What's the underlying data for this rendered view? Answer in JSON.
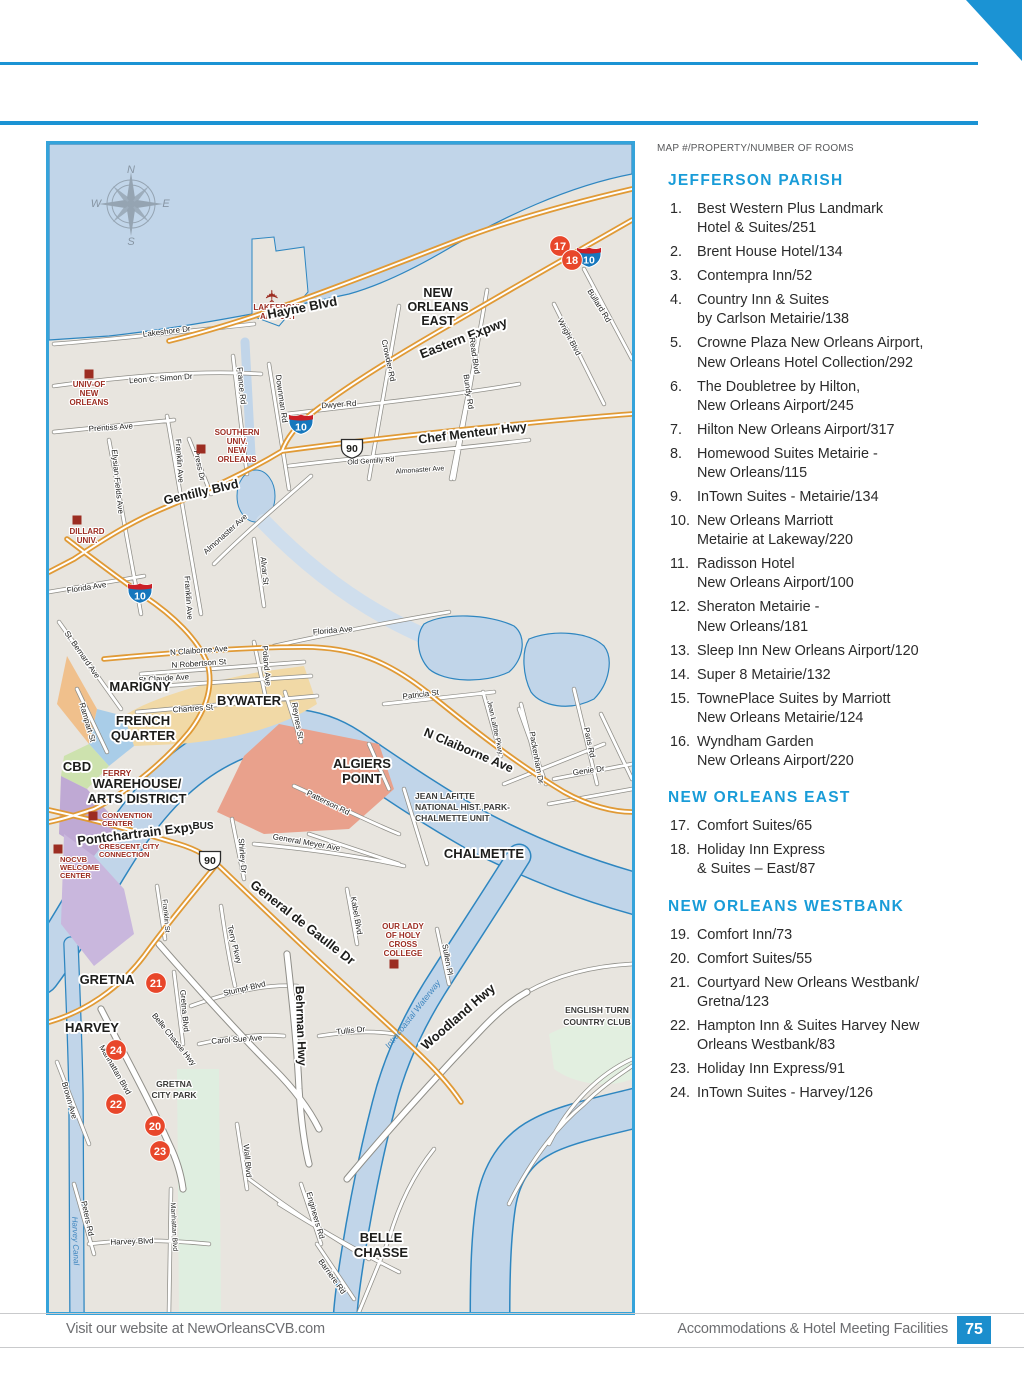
{
  "accent_colors": {
    "cyan_header": "#199cd8",
    "rule_blue": "#1b93d4",
    "page_box_blue": "#1b8ecd",
    "marker_red": "#e8472b",
    "poi_red": "#9c2d22",
    "shield_blue": "#1677bd",
    "shield_red_band": "#cb2027",
    "water": "#c1d5e9",
    "land": "#e8e5df",
    "road_orange": "#e09a36"
  },
  "listing": {
    "legend": "MAP #/PROPERTY/NUMBER OF ROOMS",
    "sections": [
      {
        "title": "JEFFERSON PARISH",
        "items": [
          {
            "n": "1.",
            "text": "Best Western Plus Landmark\nHotel & Suites/251"
          },
          {
            "n": "2.",
            "text": "Brent House Hotel/134"
          },
          {
            "n": "3.",
            "text": "Contempra Inn/52"
          },
          {
            "n": "4.",
            "text": "Country Inn & Suites\nby Carlson Metairie/138"
          },
          {
            "n": "5.",
            "text": "Crowne Plaza New Orleans Airport,\nNew Orleans Hotel Collection/292"
          },
          {
            "n": "6.",
            "text": "The Doubletree by Hilton,\nNew Orleans Airport/245"
          },
          {
            "n": "7.",
            "text": "Hilton New Orleans Airport/317"
          },
          {
            "n": "8.",
            "text": "Homewood Suites Metairie -\nNew Orleans/115"
          },
          {
            "n": "9.",
            "text": "InTown Suites - Metairie/134"
          },
          {
            "n": "10.",
            "text": "New Orleans Marriott\nMetairie at Lakeway/220"
          },
          {
            "n": "11.",
            "text": "Radisson Hotel\nNew Orleans Airport/100"
          },
          {
            "n": "12.",
            "text": "Sheraton Metairie -\nNew Orleans/181"
          },
          {
            "n": "13.",
            "text": "Sleep Inn New Orleans Airport/120"
          },
          {
            "n": "14.",
            "text": "Super 8 Metairie/132"
          },
          {
            "n": "15.",
            "text": "TownePlace Suites by Marriott\nNew Orleans Metairie/124"
          },
          {
            "n": "16.",
            "text": "Wyndham Garden\nNew Orleans Airport/220"
          }
        ]
      },
      {
        "title": "NEW ORLEANS EAST",
        "items": [
          {
            "n": "17.",
            "text": "Comfort Suites/65"
          },
          {
            "n": "18.",
            "text": "Holiday Inn Express\n& Suites – East/87"
          }
        ]
      },
      {
        "title": "NEW ORLEANS WESTBANK",
        "items": [
          {
            "n": "19.",
            "text": "Comfort Inn/73"
          },
          {
            "n": "20.",
            "text": "Comfort Suites/55"
          },
          {
            "n": "21.",
            "text": "Courtyard New Orleans Westbank/\nGretna/123"
          },
          {
            "n": "22.",
            "text": "Hampton Inn & Suites Harvey New\nOrleans Westbank/83"
          },
          {
            "n": "23.",
            "text": "Holiday Inn Express/91"
          },
          {
            "n": "24.",
            "text": "InTown Suites - Harvey/126"
          }
        ]
      }
    ]
  },
  "footer": {
    "left": "Visit our website at NewOrleansCVB.com",
    "right": "Accommodations & Hotel Meeting Facilities",
    "page": "75"
  },
  "map": {
    "compass": {
      "n": "N",
      "e": "E",
      "s": "S",
      "w": "W",
      "x": 82,
      "y": 60
    },
    "labels": [
      {
        "t": "✈",
        "x": 229,
        "y": 152,
        "s": 17,
        "c": "#9c2d22",
        "r": -90,
        "halo": false
      },
      {
        "t": "LAKEFRONT",
        "x": 229,
        "y": 166,
        "s": 8,
        "w": "b",
        "c": "#9c2d22"
      },
      {
        "t": "AIRPORT",
        "x": 229,
        "y": 175,
        "s": 8,
        "w": "b",
        "c": "#9c2d22"
      },
      {
        "t": "Lakeshore Dr",
        "x": 118,
        "y": 190,
        "r": -7
      },
      {
        "t": "Leon C. Simon Dr",
        "x": 112,
        "y": 237,
        "r": -4
      },
      {
        "t": "Hayne Blvd",
        "x": 254,
        "y": 168,
        "r": -11,
        "s": 13,
        "w": "b"
      },
      {
        "t": "Eastern Expwy",
        "x": 416,
        "y": 198,
        "r": -21,
        "s": 13,
        "w": "b"
      },
      {
        "t": "NEW",
        "x": 389,
        "y": 153,
        "s": 12.5,
        "w": "b"
      },
      {
        "t": "ORLEANS",
        "x": 389,
        "y": 167,
        "s": 12.5,
        "w": "b"
      },
      {
        "t": "EAST",
        "x": 389,
        "y": 181,
        "s": 12.5,
        "w": "b"
      },
      {
        "t": "Crowder Rd",
        "x": 337,
        "y": 217,
        "r": 78
      },
      {
        "t": "Read Blvd",
        "x": 423,
        "y": 212,
        "r": 82
      },
      {
        "t": "Bundy Rd",
        "x": 417,
        "y": 248,
        "r": 82
      },
      {
        "t": "Wright Blvd",
        "x": 518,
        "y": 194,
        "r": 62
      },
      {
        "t": "Bullard Rd",
        "x": 548,
        "y": 163,
        "r": 58
      },
      {
        "t": "Dwyer Rd",
        "x": 290,
        "y": 263,
        "r": -4
      },
      {
        "t": "Chef Menteur Hwy",
        "x": 424,
        "y": 293,
        "r": -7,
        "s": 12.5,
        "w": "b"
      },
      {
        "t": "Old Gentilly Rd",
        "x": 322,
        "y": 319,
        "r": -4,
        "s": 7
      },
      {
        "t": "Almonaster Ave",
        "x": 371,
        "y": 328,
        "r": -4,
        "s": 7
      },
      {
        "t": "Almonaster Ave",
        "x": 178,
        "y": 392,
        "r": -42
      },
      {
        "t": "Prentiss Ave",
        "x": 62,
        "y": 286,
        "r": -4
      },
      {
        "t": "Elysian Fields Ave",
        "x": 66,
        "y": 338,
        "r": 84
      },
      {
        "t": "Franklin Ave",
        "x": 128,
        "y": 317,
        "r": 86
      },
      {
        "t": "Press Dr",
        "x": 148,
        "y": 322,
        "r": 78
      },
      {
        "t": "France Rd",
        "x": 190,
        "y": 242,
        "r": 84
      },
      {
        "t": "Downman Rd",
        "x": 230,
        "y": 255,
        "r": 82
      },
      {
        "t": "Gentilly Blvd",
        "x": 153,
        "y": 352,
        "r": -13,
        "s": 12.5,
        "w": "b"
      },
      {
        "t": "SOUTHERN",
        "x": 188,
        "y": 291,
        "s": 8,
        "w": "b",
        "c": "#9c2d22"
      },
      {
        "t": "UNIV.",
        "x": 188,
        "y": 300,
        "s": 8,
        "w": "b",
        "c": "#9c2d22"
      },
      {
        "t": "NEW",
        "x": 188,
        "y": 309,
        "s": 8,
        "w": "b",
        "c": "#9c2d22"
      },
      {
        "t": "ORLEANS",
        "x": 188,
        "y": 318,
        "s": 8,
        "w": "b",
        "c": "#9c2d22"
      },
      {
        "t": "UNIV-OF",
        "x": 40,
        "y": 243,
        "s": 8,
        "w": "b",
        "c": "#9c2d22"
      },
      {
        "t": "NEW",
        "x": 40,
        "y": 252,
        "s": 8,
        "w": "b",
        "c": "#9c2d22"
      },
      {
        "t": "ORLEANS",
        "x": 40,
        "y": 261,
        "s": 8,
        "w": "b",
        "c": "#9c2d22"
      },
      {
        "t": "DILLARD",
        "x": 38,
        "y": 390,
        "s": 8,
        "w": "b",
        "c": "#9c2d22"
      },
      {
        "t": "UNIV.",
        "x": 38,
        "y": 399,
        "s": 8,
        "w": "b",
        "c": "#9c2d22"
      },
      {
        "t": "Florida Ave",
        "x": 38,
        "y": 446,
        "r": -9
      },
      {
        "t": "Florida Ave",
        "x": 284,
        "y": 489,
        "r": -5
      },
      {
        "t": "Alvar St",
        "x": 213,
        "y": 427,
        "r": 84
      },
      {
        "t": "Franklin Ave",
        "x": 137,
        "y": 454,
        "r": 86
      },
      {
        "t": "St. Bernard Ave",
        "x": 31,
        "y": 512,
        "r": 55
      },
      {
        "t": "N Claiborne Ave",
        "x": 150,
        "y": 509,
        "r": -4
      },
      {
        "t": "N Robertson St",
        "x": 150,
        "y": 522,
        "r": -4
      },
      {
        "t": "St Claude Ave",
        "x": 115,
        "y": 537,
        "r": -4
      },
      {
        "t": "Chartres St",
        "x": 144,
        "y": 567,
        "r": -4
      },
      {
        "t": "Rampart St",
        "x": 36,
        "y": 579,
        "r": 74
      },
      {
        "t": "Poland Ave",
        "x": 215,
        "y": 522,
        "r": 85
      },
      {
        "t": "Reynes St",
        "x": 246,
        "y": 577,
        "r": 80
      },
      {
        "t": "MARIGNY",
        "x": 91,
        "y": 547,
        "s": 13,
        "w": "b"
      },
      {
        "t": "BYWATER",
        "x": 200,
        "y": 561,
        "s": 13,
        "w": "b"
      },
      {
        "t": "FRENCH",
        "x": 94,
        "y": 581,
        "s": 13,
        "w": "b"
      },
      {
        "t": "QUARTER",
        "x": 94,
        "y": 596,
        "s": 13,
        "w": "b"
      },
      {
        "t": "CBD",
        "x": 28,
        "y": 627,
        "s": 13,
        "w": "b"
      },
      {
        "t": "FERRY",
        "x": 68,
        "y": 632,
        "s": 8.5,
        "w": "b",
        "c": "#9c2d22"
      },
      {
        "t": "WAREHOUSE/",
        "x": 88,
        "y": 644,
        "s": 13,
        "w": "b"
      },
      {
        "t": "ARTS DISTRICT",
        "x": 88,
        "y": 659,
        "s": 13,
        "w": "b"
      },
      {
        "t": "ALGIERS",
        "x": 313,
        "y": 624,
        "s": 13,
        "w": "b"
      },
      {
        "t": "POINT",
        "x": 313,
        "y": 639,
        "s": 13,
        "w": "b"
      },
      {
        "t": "CONVENTION",
        "x": 53,
        "y": 674,
        "s": 7.5,
        "w": "b",
        "c": "#9c2d22",
        "a": "start"
      },
      {
        "t": "CENTER",
        "x": 53,
        "y": 682,
        "s": 7.5,
        "w": "b",
        "c": "#9c2d22",
        "a": "start"
      },
      {
        "t": "Pontchartrain Expy",
        "x": 88,
        "y": 694,
        "r": -7,
        "s": 13,
        "w": "b"
      },
      {
        "t": "BUS",
        "x": 154,
        "y": 685,
        "s": 10,
        "w": "b"
      },
      {
        "t": "CRESCENT CITY",
        "x": 50,
        "y": 705,
        "s": 7.5,
        "w": "b",
        "c": "#9c2d22",
        "a": "start"
      },
      {
        "t": "CONNECTION",
        "x": 50,
        "y": 713,
        "s": 7.5,
        "w": "b",
        "c": "#9c2d22",
        "a": "start"
      },
      {
        "t": "NOCVB",
        "x": 11,
        "y": 718,
        "s": 7.5,
        "w": "b",
        "c": "#9c2d22",
        "a": "start"
      },
      {
        "t": "WELCOME",
        "x": 11,
        "y": 726,
        "s": 7.5,
        "w": "b",
        "c": "#9c2d22",
        "a": "start"
      },
      {
        "t": "CENTER",
        "x": 11,
        "y": 734,
        "s": 7.5,
        "w": "b",
        "c": "#9c2d22",
        "a": "start"
      },
      {
        "t": "Patricia St",
        "x": 372,
        "y": 553,
        "r": -7
      },
      {
        "t": "Jean Lafitte Pkwy",
        "x": 444,
        "y": 584,
        "r": 78,
        "s": 7
      },
      {
        "t": "Packenham Dr",
        "x": 485,
        "y": 614,
        "r": 80
      },
      {
        "t": "Paris Rd",
        "x": 538,
        "y": 599,
        "r": 78
      },
      {
        "t": "Genie Dr",
        "x": 540,
        "y": 629,
        "r": -8
      },
      {
        "t": "N Claiborne Ave",
        "x": 418,
        "y": 610,
        "r": 23,
        "s": 12.5,
        "w": "b"
      },
      {
        "t": "JEAN LAFITTE",
        "x": 366,
        "y": 655,
        "s": 8.5,
        "w": "b",
        "c": "#3b3b39",
        "a": "start"
      },
      {
        "t": "NATIONAL HIST. PARK-",
        "x": 366,
        "y": 666,
        "s": 8.5,
        "w": "b",
        "c": "#3b3b39",
        "a": "start"
      },
      {
        "t": "CHALMETTE UNIT",
        "x": 366,
        "y": 677,
        "s": 8.5,
        "w": "b",
        "c": "#3b3b39",
        "a": "start"
      },
      {
        "t": "CHALMETTE",
        "x": 435,
        "y": 714,
        "s": 13,
        "w": "b"
      },
      {
        "t": "Patterson Rd",
        "x": 278,
        "y": 661,
        "r": 26
      },
      {
        "t": "General Meyer Ave",
        "x": 257,
        "y": 701,
        "r": 10
      },
      {
        "t": "Shirley Dr",
        "x": 191,
        "y": 712,
        "r": 85
      },
      {
        "t": "General de Gaulle Dr",
        "x": 251,
        "y": 782,
        "r": 38,
        "s": 13,
        "w": "b"
      },
      {
        "t": "Kabel Blvd",
        "x": 305,
        "y": 772,
        "r": 80
      },
      {
        "t": "Sullen Pl",
        "x": 396,
        "y": 816,
        "r": 80
      },
      {
        "t": "OUR LADY",
        "x": 354,
        "y": 785,
        "s": 8,
        "w": "b",
        "c": "#9c2d22"
      },
      {
        "t": "OF HOLY",
        "x": 354,
        "y": 794,
        "s": 8,
        "w": "b",
        "c": "#9c2d22"
      },
      {
        "t": "CROSS",
        "x": 354,
        "y": 803,
        "s": 8,
        "w": "b",
        "c": "#9c2d22"
      },
      {
        "t": "COLLEGE",
        "x": 354,
        "y": 812,
        "s": 8,
        "w": "b",
        "c": "#9c2d22"
      },
      {
        "t": "Woodland Hwy",
        "x": 412,
        "y": 876,
        "r": -41,
        "s": 13,
        "w": "b"
      },
      {
        "t": "Intracoastal Waterway",
        "x": 366,
        "y": 872,
        "r": -52,
        "s": 8.5,
        "c": "#3f86bf",
        "i": true,
        "halo": false
      },
      {
        "t": "ENGLISH TURN",
        "x": 548,
        "y": 869,
        "s": 8.5,
        "w": "b",
        "c": "#3b3b39"
      },
      {
        "t": "COUNTRY CLUB",
        "x": 548,
        "y": 881,
        "s": 8.5,
        "w": "b",
        "c": "#3b3b39"
      },
      {
        "t": "GRETNA",
        "x": 58,
        "y": 840,
        "s": 13,
        "w": "b"
      },
      {
        "t": "HARVEY",
        "x": 43,
        "y": 888,
        "s": 13,
        "w": "b"
      },
      {
        "t": "Stumpf Blvd",
        "x": 196,
        "y": 847,
        "r": -13
      },
      {
        "t": "Terry Pkwy",
        "x": 183,
        "y": 801,
        "r": 76
      },
      {
        "t": "Behrman Hwy",
        "x": 248,
        "y": 882,
        "r": 88,
        "s": 12,
        "w": "b"
      },
      {
        "t": "Carol Sue Ave",
        "x": 188,
        "y": 898,
        "r": -4
      },
      {
        "t": "Tullis Dr",
        "x": 302,
        "y": 889,
        "r": -6
      },
      {
        "t": "Belle Chasse Hwy",
        "x": 123,
        "y": 897,
        "r": 51
      },
      {
        "t": "Gretna Blvd",
        "x": 133,
        "y": 867,
        "r": 85
      },
      {
        "t": "Manhattan Blvd",
        "x": 64,
        "y": 927,
        "r": 60
      },
      {
        "t": "Brown Ave",
        "x": 18,
        "y": 957,
        "r": 74
      },
      {
        "t": "Franklin St",
        "x": 115,
        "y": 772,
        "r": 85,
        "s": 7
      },
      {
        "t": "GRETNA",
        "x": 125,
        "y": 943,
        "s": 8.5,
        "w": "b",
        "c": "#3b3b39"
      },
      {
        "t": "CITY PARK",
        "x": 125,
        "y": 954,
        "s": 8.5,
        "w": "b",
        "c": "#3b3b39"
      },
      {
        "t": "Wall Blvd",
        "x": 196,
        "y": 1017,
        "r": 85
      },
      {
        "t": "Peters Rd",
        "x": 36,
        "y": 1075,
        "r": 78
      },
      {
        "t": "Manhattan Blvd",
        "x": 123,
        "y": 1083,
        "r": 87,
        "s": 7
      },
      {
        "t": "Harvey Blvd",
        "x": 83,
        "y": 1100,
        "r": -2
      },
      {
        "t": "Harvey Canal",
        "x": 24,
        "y": 1097,
        "r": 88,
        "s": 8,
        "c": "#3f86bf",
        "i": true,
        "halo": false
      },
      {
        "t": "Engineers Rd",
        "x": 264,
        "y": 1072,
        "r": 74
      },
      {
        "t": "Barriere Rd",
        "x": 281,
        "y": 1134,
        "r": 54
      },
      {
        "t": "BELLE",
        "x": 332,
        "y": 1098,
        "s": 13,
        "w": "b"
      },
      {
        "t": "CHASSE",
        "x": 332,
        "y": 1113,
        "s": 13,
        "w": "b"
      }
    ],
    "squares": [
      {
        "x": 40,
        "y": 230
      },
      {
        "x": 152,
        "y": 305
      },
      {
        "x": 28,
        "y": 376
      },
      {
        "x": 44,
        "y": 672
      },
      {
        "x": 9,
        "y": 705
      },
      {
        "x": 345,
        "y": 820
      }
    ],
    "shields": [
      {
        "type": "i10",
        "label": "10",
        "x": 540,
        "y": 113
      },
      {
        "type": "i10",
        "label": "10",
        "x": 252,
        "y": 280
      },
      {
        "type": "i10",
        "label": "10",
        "x": 91,
        "y": 449
      },
      {
        "type": "us90",
        "label": "90",
        "x": 303,
        "y": 304
      },
      {
        "type": "us90",
        "label": "90",
        "x": 161,
        "y": 716
      }
    ],
    "markers": [
      {
        "n": "17",
        "x": 511,
        "y": 102
      },
      {
        "n": "18",
        "x": 523,
        "y": 116
      },
      {
        "n": "21",
        "x": 107,
        "y": 839
      },
      {
        "n": "24",
        "x": 67,
        "y": 906
      },
      {
        "n": "22",
        "x": 67,
        "y": 960
      },
      {
        "n": "20",
        "x": 106,
        "y": 982
      },
      {
        "n": "23",
        "x": 111,
        "y": 1007
      }
    ]
  }
}
